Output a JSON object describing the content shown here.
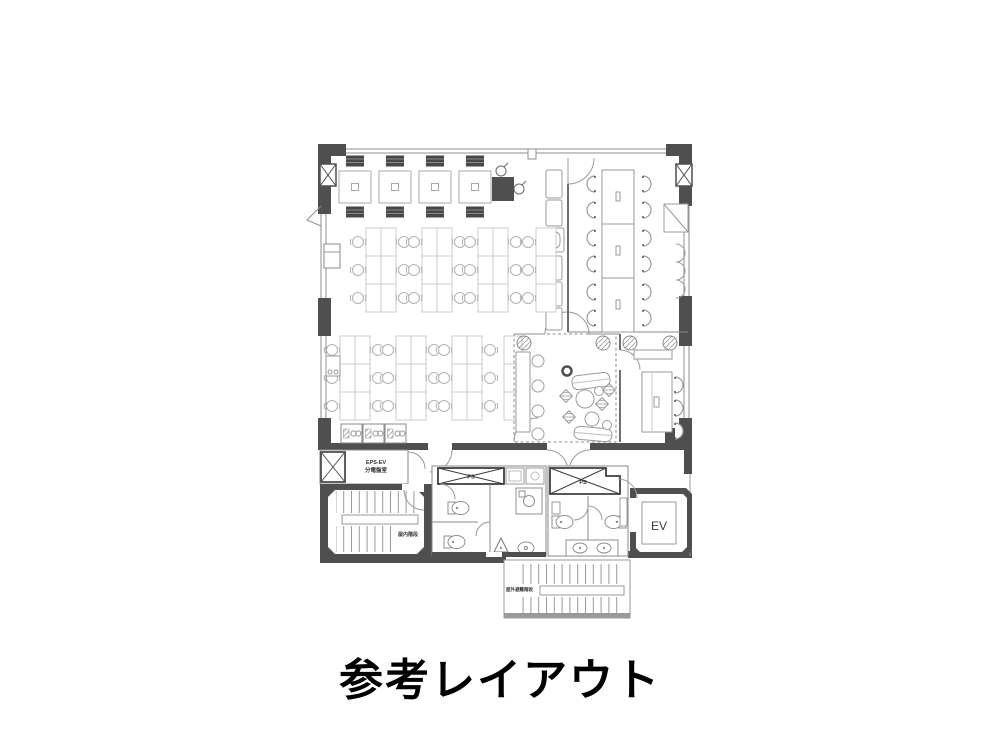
{
  "title": {
    "text": "参考レイアウト"
  },
  "floor_plan": {
    "labels": {
      "ps": "PS",
      "elevator": "EV",
      "eps_ev": "EPS-EV",
      "distribution_board_room": "分電盤室",
      "indoor_staircase": "屋内階段",
      "outdoor_evacuation_staircase": "屋外避難階段"
    },
    "colors": {
      "background": "#ffffff",
      "wall": "#4f4f4f",
      "window_line": "#8f8f8f",
      "furniture_line": "#a9a9a9",
      "desk_line": "#cbcbcb",
      "dark_chair": "#474747",
      "title_text": "#000000"
    }
  }
}
